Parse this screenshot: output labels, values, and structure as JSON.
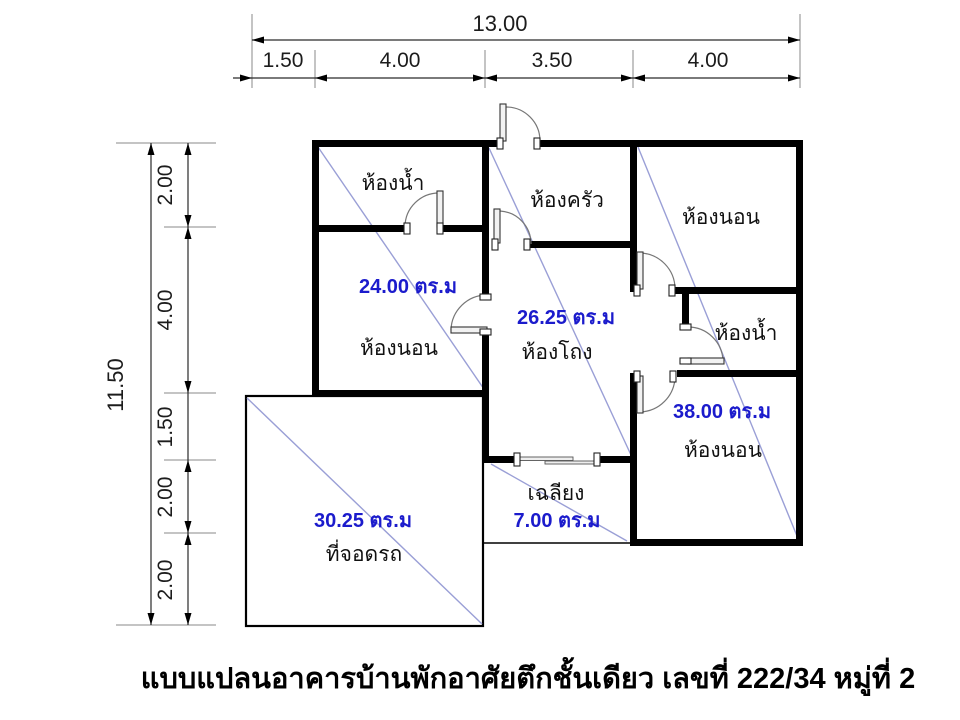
{
  "caption": "แบบแปลนอาคารบ้านพักอาศัยตึกชั้นเดียว เลขที่ 222/34 หมู่ที่ 2",
  "colors": {
    "wall": "#000000",
    "area_label": "#1b1bcc",
    "diagonal_line": "#9a9fd6",
    "dimension_text": "#1c1c1c",
    "background": "#ffffff"
  },
  "dimensions": {
    "top": {
      "total": "13.00",
      "segments": [
        "1.50",
        "4.00",
        "3.50",
        "4.00"
      ]
    },
    "left": {
      "total": "11.50",
      "segments": [
        "2.00",
        "4.00",
        "1.50",
        "2.00",
        "2.00"
      ]
    }
  },
  "rooms": {
    "bathroom_top_left": {
      "label": "ห้องน้ำ"
    },
    "kitchen": {
      "label": "ห้องครัว"
    },
    "bedroom_top_right": {
      "label": "ห้องนอน"
    },
    "bedroom_left": {
      "label": "ห้องนอน",
      "area": "24.00 ตร.ม"
    },
    "hall": {
      "label": "ห้องโถง",
      "area": "26.25 ตร.ม"
    },
    "bathroom_right": {
      "label": "ห้องน้ำ"
    },
    "bedroom_bottom_right": {
      "label": "ห้องนอน",
      "area": "38.00 ตร.ม"
    },
    "porch": {
      "label": "เฉลียง",
      "area": "7.00 ตร.ม"
    },
    "carport": {
      "label": "ที่จอดรถ",
      "area": "30.25 ตร.ม"
    }
  }
}
